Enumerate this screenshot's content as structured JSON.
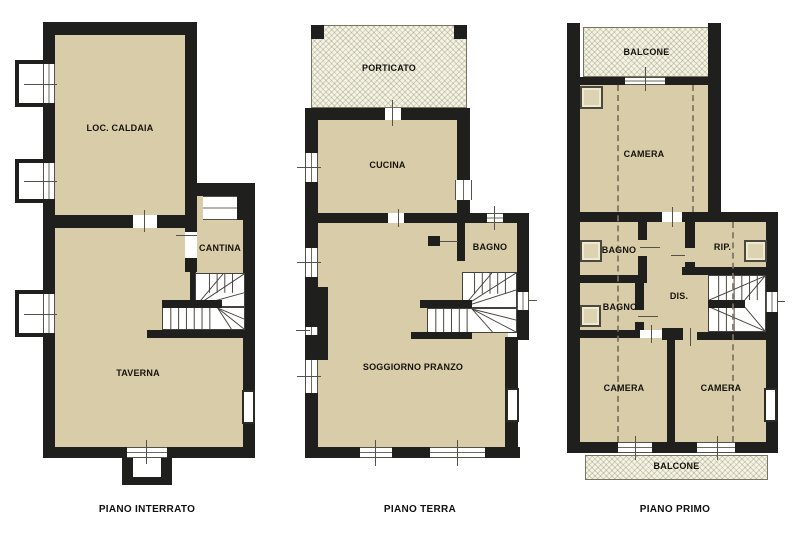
{
  "document_type": "floor-plan-drawing",
  "plans": {
    "interrato": {
      "title": "PIANO INTERRATO",
      "rooms": {
        "caldaia": "LOC. CALDAIA",
        "cantina": "CANTINA",
        "taverna": "TAVERNA"
      }
    },
    "terra": {
      "title": "PIANO TERRA",
      "rooms": {
        "porticato": "PORTICATO",
        "cucina": "CUCINA",
        "bagno": "BAGNO",
        "soggiorno": "SOGGIORNO PRANZO"
      }
    },
    "primo": {
      "title": "PIANO PRIMO",
      "rooms": {
        "balcone_top": "BALCONE",
        "camera": "CAMERA",
        "bagno_1": "BAGNO",
        "bagno_2": "BAGNO",
        "rip": "RIP.",
        "dis": "DIS.",
        "camera_left": "CAMERA",
        "camera_right": "CAMERA",
        "balcone_bottom": "BALCONE"
      }
    }
  },
  "colors": {
    "room_fill": "#D9CDA9",
    "wall": "#1F1F1D",
    "hatch_fill": "#F5F3E3",
    "line": "#55524A",
    "background": "#FFFFFF"
  }
}
